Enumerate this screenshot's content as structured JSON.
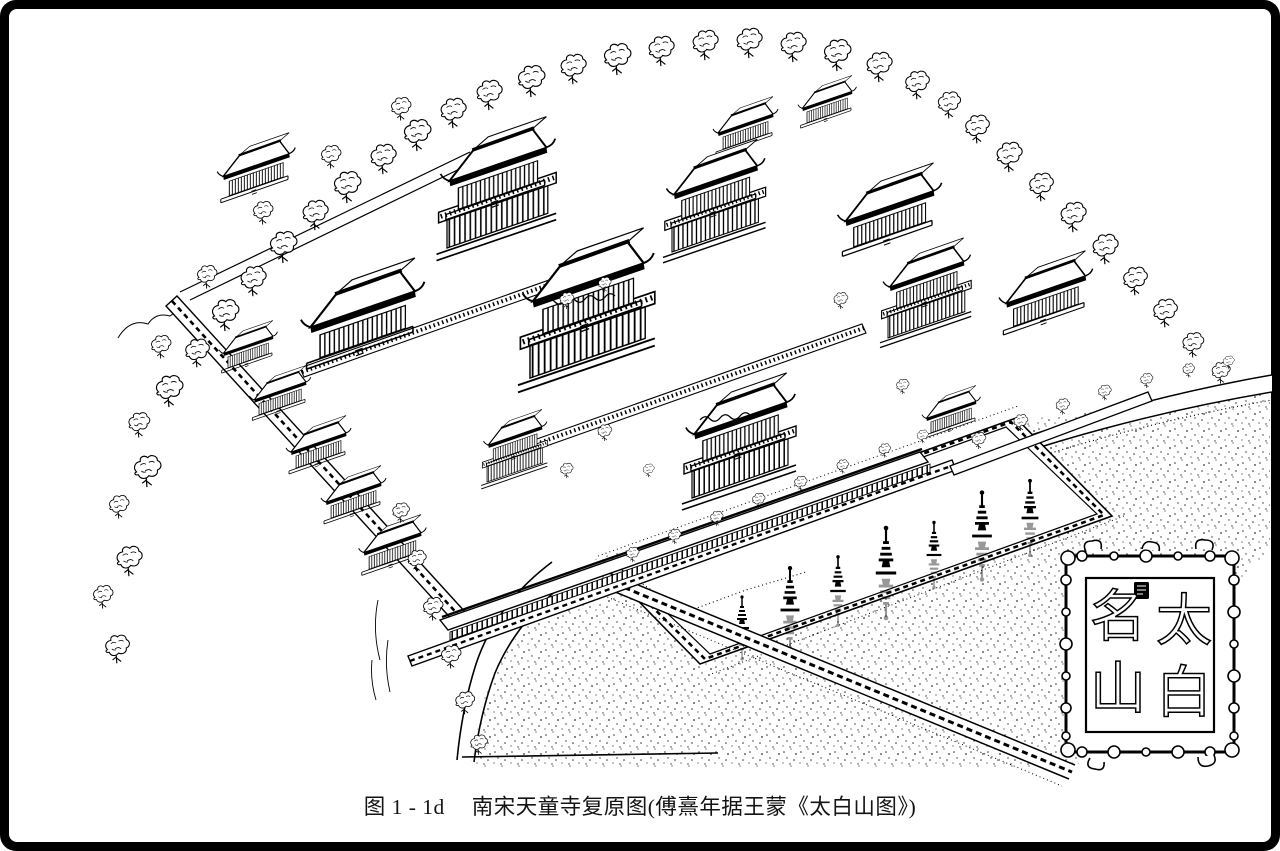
{
  "page": {
    "paper_color": "#ffffff",
    "ink_color": "#000000",
    "frame_color": "#000000"
  },
  "figure": {
    "caption_label": "图 1 - 1d",
    "caption_title": "南宋天童寺复原图(傅熹年据王蒙《太白山图》)",
    "caption_full": "图 1 - 1d　南宋天童寺复原图(傅熹年据王蒙《太白山图》)"
  },
  "seal": {
    "reading": "太白名山",
    "right_top": "太",
    "right_bottom": "白",
    "left_top": "名",
    "left_bottom": "山"
  },
  "illustration": {
    "subject": "南宋天童寺复原图",
    "features": [
      "walled temple compound in bird's-eye view",
      "multi-storey halls and gate tower",
      "pine forest along the hillside",
      "pond with row of stupas and reflections",
      "stippled forecourt and curved roads",
      "ornate cloud-border seal cartouche"
    ]
  }
}
